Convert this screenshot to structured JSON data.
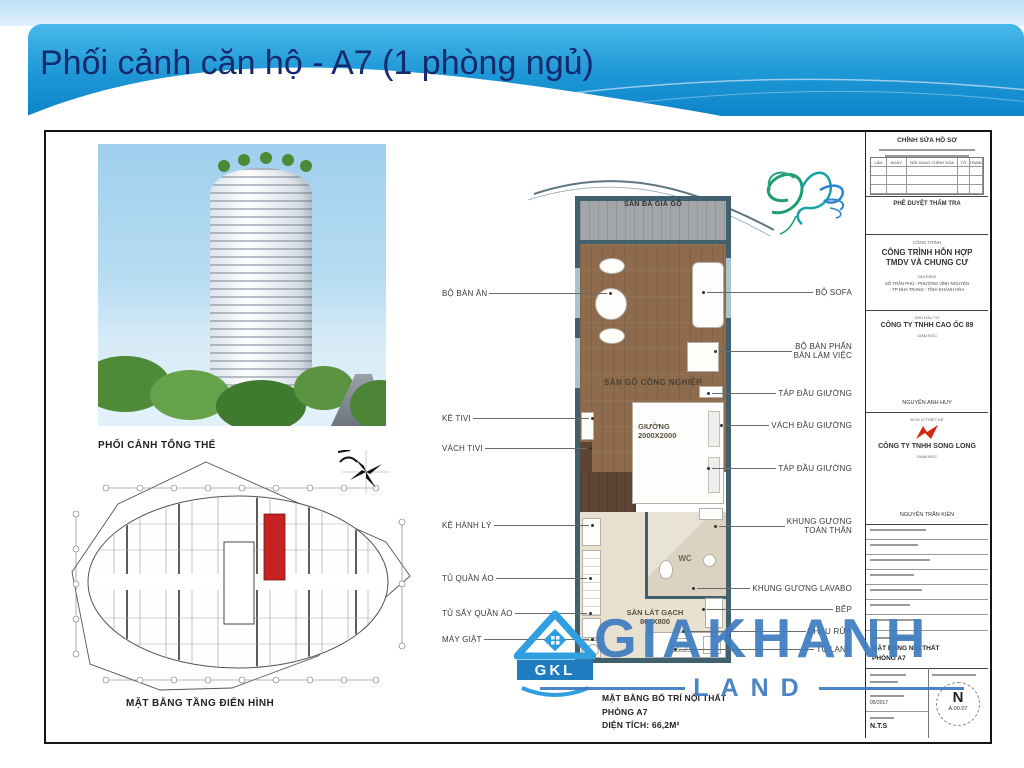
{
  "slide": {
    "title": "Phối cảnh căn hộ - A7 (1 phòng ngủ)"
  },
  "left_panel": {
    "photo_caption": "PHỐI CẢNH TỔNG THỂ",
    "plan_caption": "MẶT BẰNG TẦNG ĐIỂN HÌNH"
  },
  "unit_plan": {
    "balcony_label": "SÀN ĐÁ GIẢ GỖ",
    "floor_label": "SÀN GỖ CÔNG NGHIỆP",
    "bed_label": "GIƯỜNG\n2000X2000",
    "wc_label": "WC",
    "tile_label": "SÀN LÁT GẠCH\n800X800",
    "callouts_left": [
      "BỘ BÀN ĂN",
      "KỆ TIVI",
      "VÁCH TIVI",
      "KỆ HÀNH LÝ",
      "TỦ QUẦN ÁO",
      "TỦ SẤY QUẦN ÁO",
      "MÁY GIẶT"
    ],
    "callouts_right": [
      "BỘ SOFA",
      "BỘ BÀN PHẤN\nBÀN LÀM VIỆC",
      "TÁP ĐẦU GIƯỜNG",
      "VÁCH ĐẦU GIƯỜNG",
      "TÁP ĐẦU GIƯỜNG",
      "KHUNG GƯƠNG\nTOÀN THÂN",
      "KHUNG GƯƠNG LAVABO",
      "BẾP",
      "CHẬU RỬA",
      "TỦ LẠNH"
    ],
    "caption": "MẶT BẰNG BỐ TRÍ NỘI THẤT\nPHÒNG A7\nDIỆN TÍCH: 66,2M²"
  },
  "title_block": {
    "revision_header": "CHỈNH SỬA HỒ SƠ",
    "revision_columns": [
      "LẦN",
      "NGÀY",
      "NỘI DUNG CHỈNH SỬA",
      "TỜ",
      "TRANG"
    ],
    "approval_header": "PHÊ DUYỆT THẨM TRA",
    "project_label": "CÔNG TRÌNH",
    "project_name": "CÔNG TRÌNH HỖN HỢP\nTMDV VÀ CHUNG CƯ",
    "location_label": "ĐỊA ĐIỂM",
    "location": "SỐ TRẦN PHÚ - PHƯỜNG VĨNH NGUYÊN\n- TP NHA TRANG - TỈNH KHÁNH HÒA",
    "investor_label": "CHỦ ĐẦU TƯ",
    "investor_name": "CÔNG TY TNHH CAO ỐC 89",
    "investor_role": "GIÁM ĐỐC",
    "investor_signer": "NGUYỄN ANH HUY",
    "designer_label": "ĐƠN VỊ THIẾT KẾ",
    "designer_name": "CÔNG TY TNHH SONG LONG",
    "designer_role": "GIÁM ĐỐC",
    "designer_signer": "NGUYỄN TRẦN KIÊN",
    "drawing_title": "MẶT BẰNG NỘI THẤT\nPHÒNG A7",
    "date_value": "05/2017",
    "scale_value": "N.T.S",
    "north_letter": "N",
    "drawing_number": "A.00.07"
  },
  "watermark": {
    "logo_text": "GKL",
    "name": "GIAKHANH",
    "sub": "LAND"
  },
  "colors": {
    "banner_top": "#47b8ea",
    "banner_bottom": "#0d84c9",
    "title_text": "#15296d",
    "wall": "#41606e",
    "wood_floor": "#8d6b4c",
    "tile_floor": "#e9e1d0",
    "balcony": "#a2a6a8",
    "highlight_unit": "#c62222",
    "watermark_blue": "#3e7cbe",
    "designer_logo_red": "#cf2a0e"
  }
}
